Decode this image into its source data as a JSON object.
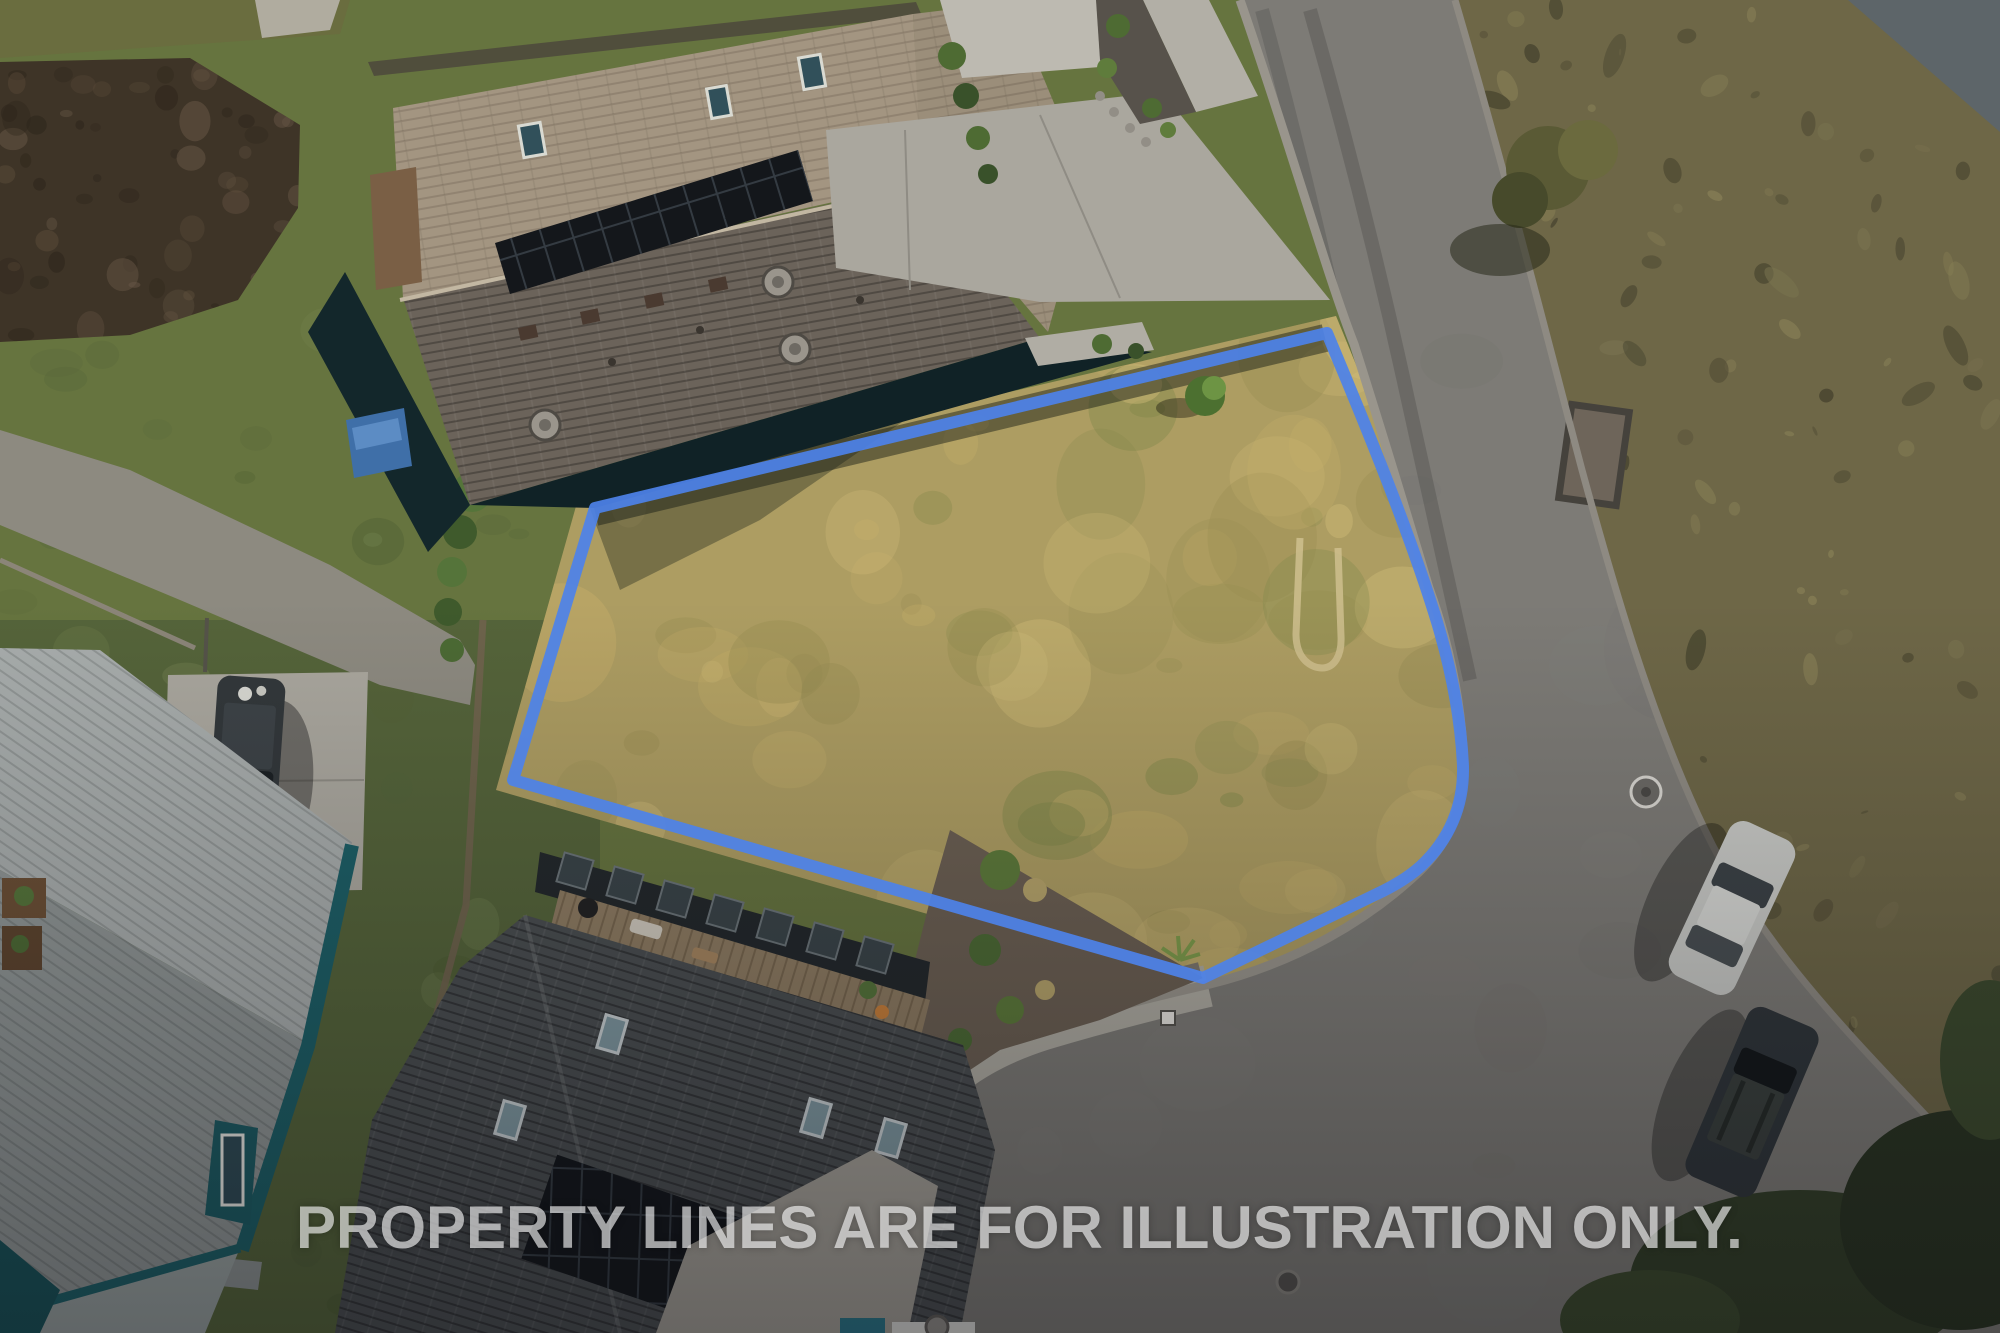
{
  "photo": {
    "kind": "aerial-drone-photo",
    "width_px": 2000,
    "height_px": 1333
  },
  "watermark": {
    "text": "PROPERTY LINES ARE FOR ILLUSTRATION ONLY.",
    "color": "rgba(255,255,255,0.62)"
  },
  "property_boundary": {
    "color": "#4d82e9",
    "stroke_width": 12,
    "path_d": "M 595,508 L 1327,333 C 1372,440 1412,540 1437,622 C 1452,672 1461,722 1463,766 C 1464,806 1449,840 1421,866 C 1410,876 1397,884 1383,891 L 1203,978 L 513,780 Z",
    "lot_fill_d": "M 580,492 L 1336,316 C 1384,432 1424,536 1450,620 C 1466,672 1475,722 1477,768 C 1478,812 1462,850 1432,878 C 1420,890 1405,898 1390,905 L 1206,994 L 496,790 Z"
  },
  "palette": {
    "lot_grass": "#ad9d62",
    "lawn_green": "#66743f",
    "lawn_dark": "#55643a",
    "road_asphalt": "#7d7b76",
    "scrub_brown": "#6e6747",
    "dirt_brown": "#3e3427",
    "gravel_gray": "#8d8a80",
    "concrete_light": "#aaa79e",
    "sidewalk": "#b2afa6",
    "roof_tan": "#a39581",
    "roof_tan_wing": "#9b8e7a",
    "roof_brown_dark": "#6b635a",
    "roof_charcoal": "#4a4e50",
    "roof_gray_light": "#a8adac",
    "roof_gray_mid": "#8f9594",
    "teal_wall": "#1d5f66",
    "house_shadow_wall": "#102226",
    "deck_wood": "#8d7b61",
    "solar_panel": "#14171b",
    "curb": "#99958c",
    "car_silver": "#c9cac6",
    "car_dark_suv_right": "#30363a",
    "car_dark_suv_left": "#33383b",
    "tarp_blue": "#3f6fa8",
    "bush_green": "#4e6b33",
    "overlay_bottom": "rgba(8,8,14,0.34)"
  }
}
